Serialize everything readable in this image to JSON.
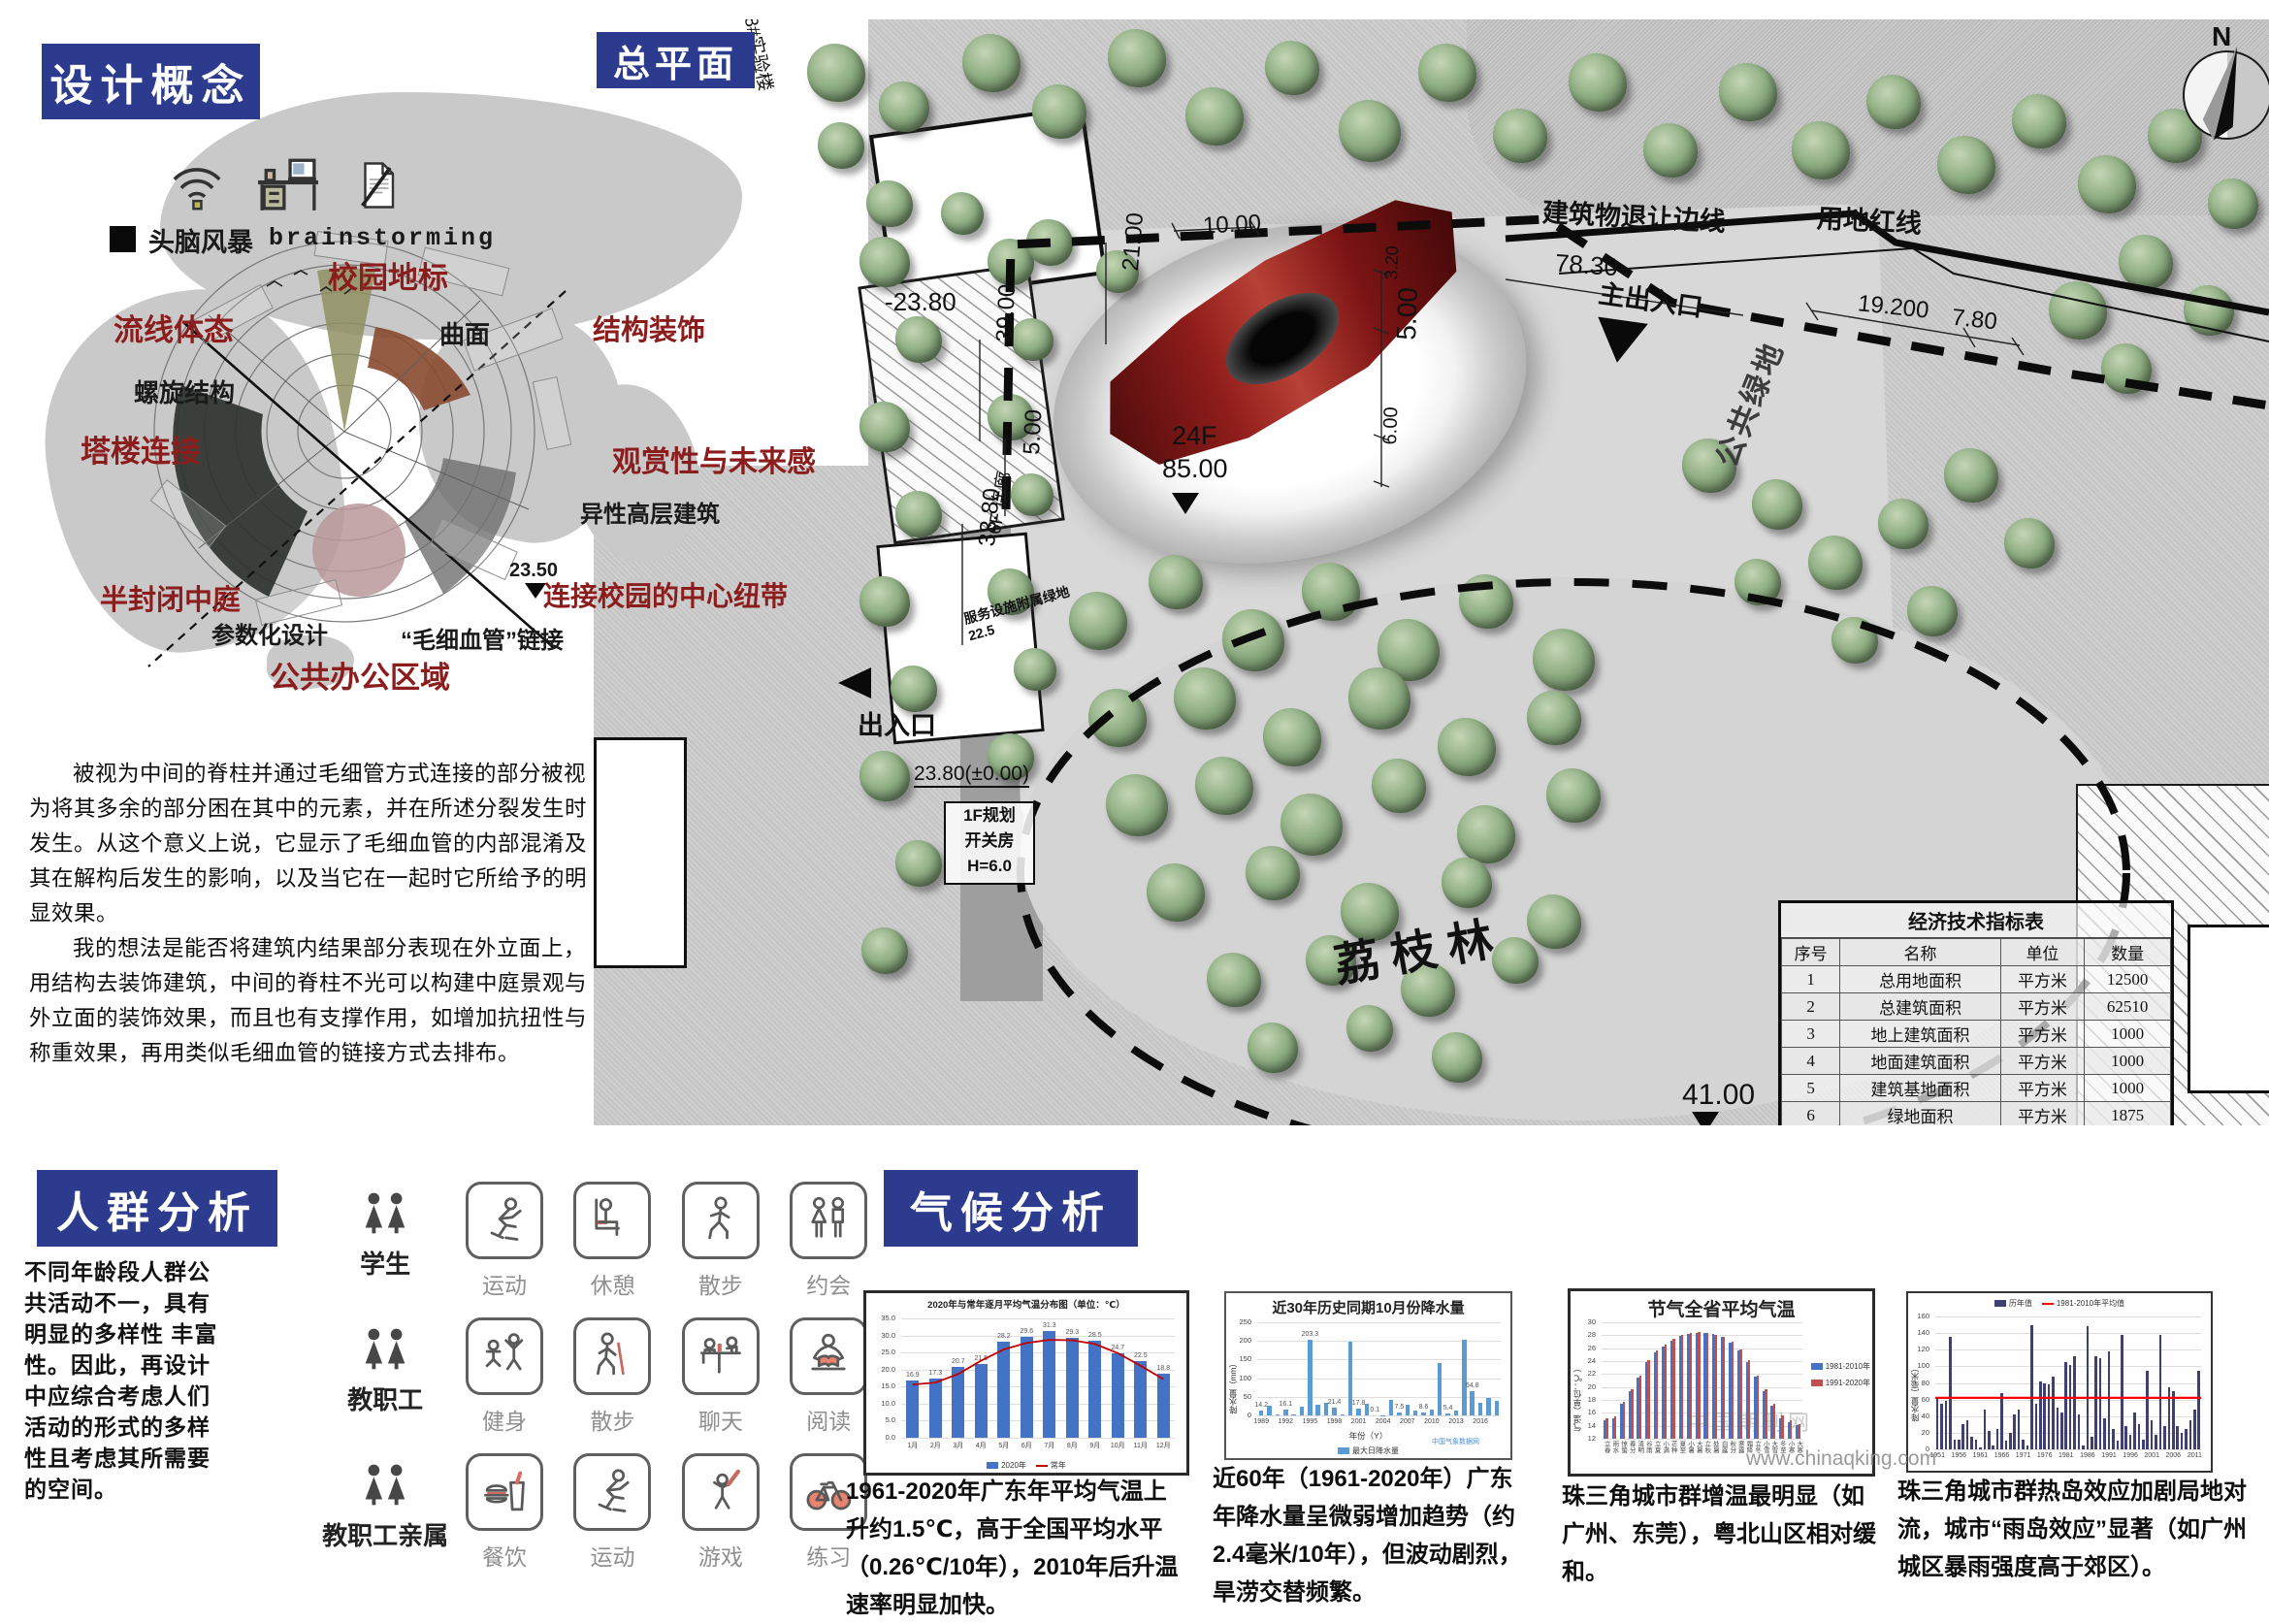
{
  "design_concept": {
    "header": "设计概念",
    "brainstorm_cn": "头脑风暴",
    "brainstorm_en": "brainstorming",
    "labels": {
      "campus_landmark": "校园地标",
      "streamline_form": "流线体态",
      "curved_surface": "曲面",
      "structure_decoration": "结构装饰",
      "spiral_structure": "螺旋结构",
      "tower_connection": "塔楼连接",
      "view_future": "观赏性与未来感",
      "atypical_highrise": "异性高层建筑",
      "semi_enclosed_atrium": "半封闭中庭",
      "elevation_2350": "23.50",
      "central_link": "连接校园的中心纽带",
      "parametric_design": "参数化设计",
      "capillary_link": "“毛细血管”链接",
      "public_office": "公共办公区域"
    },
    "paragraphs": [
      "被视为中间的脊柱并通过毛细管方式连接的部分被视为将其多余的部分困在其中的元素，并在所述分裂发生时发生。从这个意义上说，它显示了毛细血管的内部混淆及其在解构后发生的影响，以及当它在一起时它所给予的明显效果。",
      "我的想法是能否将建筑内结果部分表现在外立面上，用结构去装饰建筑，中间的脊柱不光可以构建中庭景观与外立面的装饰效果，而且也有支撑作用，如增加抗扭性与称重效果，再用类似毛细血管的链接方式去排布。"
    ]
  },
  "master_plan": {
    "header": "总平面",
    "compass_n": "N",
    "labels": {
      "lab_building": "8#实验楼",
      "minus2380": "-23.80",
      "d1000": "10.00",
      "d2100": "21.00",
      "d3900": "39.00",
      "d500l": "5.00",
      "d3380": "33.80",
      "setback_line": "建筑物退让边线",
      "d7830": "78.30",
      "red_line": "用地红线",
      "main_entrance": "主出入口",
      "d19200": "19.200",
      "d780": "7.80",
      "corridor_6f": "6F 连廊",
      "corridor_5f": "5F 连廊",
      "service_green": "服务设施附属绿地",
      "service_green_elev": "22.5",
      "entrance": "出入口",
      "d2380": "23.80(±0.00)",
      "switch_house_1": "1F规划",
      "switch_house_2": "开关房",
      "switch_house_3": "H=6.0",
      "tower_floors": "24F",
      "tower_height": "85.00",
      "public_green": "公共绿地",
      "d320": "3.20",
      "d500r": "5.00",
      "d600": "6.00",
      "lychee_grove": "荔枝林",
      "d4100": "41.00"
    },
    "table": {
      "title": "经济技术指标表",
      "headers": [
        "序号",
        "名称",
        "单位",
        "数量"
      ],
      "rows": [
        [
          "1",
          "总用地面积",
          "平方米",
          "12500"
        ],
        [
          "2",
          "总建筑面积",
          "平方米",
          "62510"
        ],
        [
          "3",
          "地上建筑面积",
          "平方米",
          "1000"
        ],
        [
          "4",
          "地面建筑面积",
          "平方米",
          "1000"
        ],
        [
          "5",
          "建筑基地面积",
          "平方米",
          "1000"
        ],
        [
          "6",
          "绿地面积",
          "平方米",
          "1875"
        ],
        [
          "7",
          "容积率",
          "",
          "4.9"
        ],
        [
          "8",
          "建筑密度",
          "%",
          "38.60%"
        ],
        [
          "9",
          "绿地率",
          "%",
          "15%"
        ]
      ]
    }
  },
  "crowd": {
    "header": "人群分析",
    "description": "不同年龄段人群公共活动不一，具有明显的多样性 丰富性。因此，再设计中应综合考虑人们活动的形式的多样性且考虑其所需要的空间。",
    "groups": [
      {
        "name": "学生",
        "activities": [
          {
            "label": "运动",
            "icon": "skate"
          },
          {
            "label": "休憩",
            "icon": "sit"
          },
          {
            "label": "散步",
            "icon": "walk"
          },
          {
            "label": "约会",
            "icon": "couple"
          }
        ]
      },
      {
        "name": "教职工",
        "activities": [
          {
            "label": "健身",
            "icon": "stretch"
          },
          {
            "label": "散步",
            "icon": "cane"
          },
          {
            "label": "聊天",
            "icon": "chat"
          },
          {
            "label": "阅读",
            "icon": "read"
          }
        ]
      },
      {
        "name": "教职工亲属",
        "activities": [
          {
            "label": "餐饮",
            "icon": "food"
          },
          {
            "label": "运动",
            "icon": "skate"
          },
          {
            "label": "游戏",
            "icon": "bat"
          },
          {
            "label": "练习",
            "icon": "bike"
          }
        ]
      }
    ]
  },
  "climate": {
    "header": "气候分析",
    "captions": [
      "1961-2020年广东年平均气温上升约1.5℃，高于全国平均水平（0.26℃/10年），2010年后升温速率明显加快。",
      "近60年（1961-2020年）广东年降水量呈微弱增加趋势（约2.4毫米/10年），但波动剧烈，旱涝交替频繁。",
      "珠三角城市群增温最明显（如广州、东莞），粤北山区相对缓和。",
      "珠三角城市群热岛效应加剧局地对流，城市“雨岛效应”显著（如广州城区暴雨强度高于郊区）。"
    ],
    "watermark_journal": "中国期刊网",
    "watermark_url": "www.chinaqking.com",
    "watermark_cma": "中国气象数据网"
  },
  "chart_data": [
    {
      "type": "bar",
      "title": "2020年与常年逐月平均气温分布图（单位：℃）",
      "categories": [
        "1月",
        "2月",
        "3月",
        "4月",
        "5月",
        "6月",
        "7月",
        "8月",
        "9月",
        "10月",
        "11月",
        "12月"
      ],
      "ylim": [
        0,
        35
      ],
      "yticks": [
        0,
        5,
        10,
        15,
        20,
        25,
        30,
        35
      ],
      "series": [
        {
          "name": "2020年",
          "type": "bar",
          "color": "#4472c4",
          "values": [
            16.9,
            17.3,
            20.7,
            21.5,
            28.2,
            29.6,
            31.3,
            29.3,
            28.5,
            24.7,
            22.5,
            18.8
          ],
          "labels": [
            "16.9",
            "17.3",
            "20.7",
            "21.5",
            "28.2",
            "29.6",
            "31.3",
            "29.3",
            "28.5",
            "24.7",
            "22.5",
            "18.8"
          ]
        },
        {
          "name": "常年",
          "type": "line",
          "color": "#c00000",
          "values": [
            15.6,
            16.2,
            18.7,
            22.6,
            25.9,
            27.8,
            28.7,
            28.6,
            27.5,
            24.8,
            21.1,
            17.2
          ]
        }
      ]
    },
    {
      "type": "bar",
      "title": "近30年历史同期10月份降水量",
      "x_start": 1989,
      "xticks": [
        1989,
        1992,
        1995,
        1998,
        2001,
        2004,
        2007,
        2010,
        2013,
        2016
      ],
      "xlabel": "年份（Y）",
      "ylabel": "降水量（mm）",
      "ylim": [
        0,
        250
      ],
      "yticks": [
        0,
        50,
        100,
        150,
        200,
        250
      ],
      "series": [
        {
          "name": "最大日降水量",
          "type": "bar",
          "color": "#5b9bd5",
          "values": [
            14.2,
            26,
            2,
            16.1,
            2,
            23,
            203.3,
            29,
            33,
            21.4,
            3,
            198,
            17.8,
            31,
            0.1,
            1,
            41,
            7.5,
            28,
            12,
            8.6,
            16,
            142,
            5.4,
            13,
            204,
            64.8,
            33,
            46,
            40
          ],
          "labels": [
            "14.2",
            null,
            null,
            "16.1",
            null,
            null,
            "203.3",
            null,
            null,
            "21.4",
            null,
            null,
            "17.8",
            null,
            "0.1",
            null,
            null,
            "7.5",
            null,
            null,
            "8.6",
            null,
            null,
            "5.4",
            null,
            null,
            "64.8",
            null,
            null,
            null
          ]
        }
      ]
    },
    {
      "type": "bar",
      "title": "节气全省平均气温",
      "categories": [
        "立春",
        "雨水",
        "惊蛰",
        "春分",
        "清明",
        "谷雨",
        "立夏",
        "小满",
        "芒种",
        "夏至",
        "小暑",
        "大暑",
        "立秋",
        "处暑",
        "白露",
        "秋分",
        "寒露",
        "霜降",
        "立冬",
        "小雪",
        "大雪",
        "冬至",
        "小寒",
        "大寒"
      ],
      "ylabel": "气温（单位：℃）",
      "ylim": [
        12,
        30
      ],
      "yticks": [
        12,
        14,
        16,
        18,
        20,
        22,
        24,
        26,
        28,
        30
      ],
      "series": [
        {
          "name": "1981-2010年",
          "type": "bar",
          "color": "#4472c4",
          "values": [
            14.9,
            15.1,
            17.4,
            19.3,
            21.4,
            23.8,
            25.3,
            26.3,
            27.2,
            27.9,
            28.2,
            28.4,
            28.4,
            28.2,
            27.7,
            26.9,
            25.7,
            23.9,
            21.6,
            19.3,
            17.1,
            15.2,
            14.6,
            14.1
          ]
        },
        {
          "name": "1991-2020年",
          "type": "bar",
          "color": "#c0504d",
          "values": [
            15.1,
            15.4,
            17.7,
            19.6,
            21.7,
            24.1,
            25.6,
            26.5,
            27.4,
            28.1,
            28.4,
            28.5,
            28.4,
            28.1,
            27.8,
            27.0,
            25.8,
            24.1,
            21.8,
            19.7,
            17.4,
            15.6,
            14.9,
            14.3
          ]
        }
      ]
    },
    {
      "type": "bar",
      "title": "",
      "x_start": 1951,
      "xticks": [
        1951,
        1956,
        1961,
        1966,
        1971,
        1976,
        1981,
        1986,
        1991,
        1996,
        2001,
        2006,
        2011
      ],
      "ylabel": "降水量（毫米）",
      "ylim": [
        0,
        160
      ],
      "yticks": [
        0,
        20,
        40,
        60,
        80,
        100,
        120,
        140,
        160
      ],
      "series": [
        {
          "name": "历年值",
          "type": "bar",
          "color": "#3f3f73",
          "values": [
            62,
            55,
            58,
            135,
            12,
            12,
            30,
            35,
            15,
            12,
            2,
            48,
            22,
            5,
            25,
            68,
            10,
            20,
            42,
            48,
            12,
            5,
            150,
            55,
            82,
            80,
            78,
            88,
            50,
            45,
            105,
            102,
            112,
            42,
            5,
            148,
            15,
            112,
            110,
            38,
            118,
            25,
            10,
            138,
            28,
            18,
            45,
            30,
            12,
            95,
            35,
            18,
            138,
            28,
            75,
            70,
            28,
            20,
            25,
            35,
            48,
            95
          ]
        }
      ],
      "refline": {
        "name": "1981-2010年平均值",
        "value": 62,
        "color": "#ff0000"
      }
    }
  ]
}
